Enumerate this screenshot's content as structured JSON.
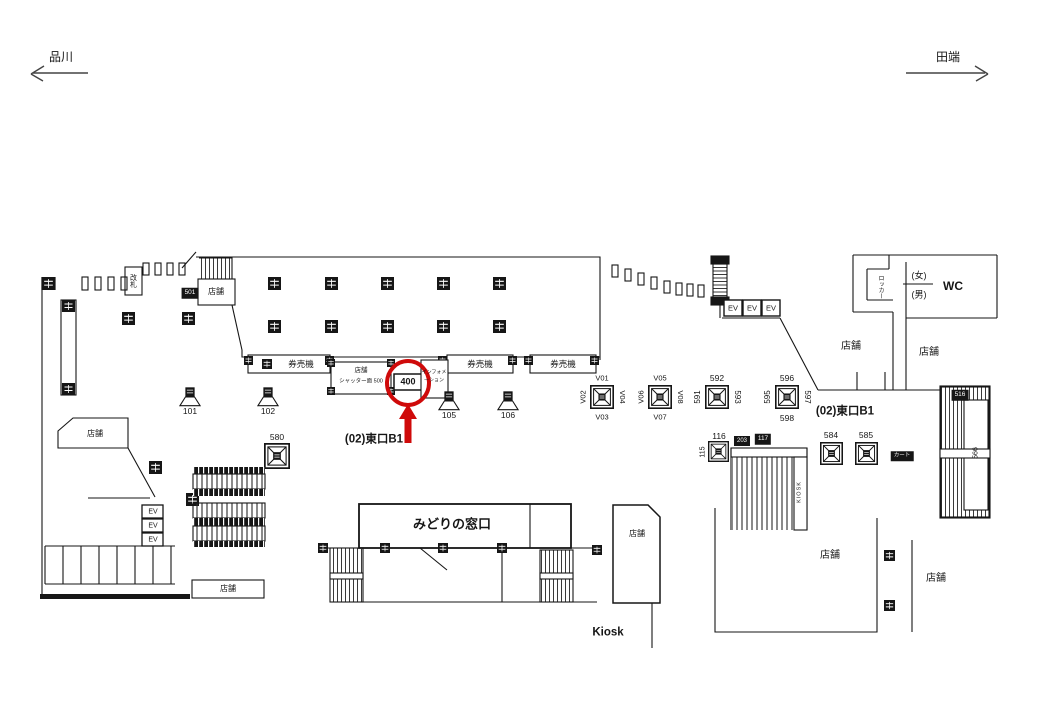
{
  "header": {
    "left_station": "品川",
    "right_station": "田端"
  },
  "areas": {
    "kaisatsu": "改札",
    "tenpo": "店舗",
    "kenbaiki": "券売機",
    "shutter_line1": "店舗",
    "shutter_line2": "シャッター面 500",
    "info_line1": "インフォメ",
    "info_line2": "ーション",
    "higashiguchi": "(02)東口B1",
    "midori": "みどりの窓口",
    "kiosk": "Kiosk",
    "kiosk_vertical": "KIOSK",
    "wc": "WC",
    "women": "(女)",
    "men": "(男)",
    "locker": "ロッカー",
    "cart": "カート",
    "ev": "EV"
  },
  "highlight": {
    "value": "400",
    "color": "#cf0a0a"
  },
  "pillars": {
    "n101": "101",
    "n102": "102",
    "n105": "105",
    "n106": "106",
    "n115": "115",
    "n116": "116",
    "n117": "117",
    "n203": "203",
    "n501": "501",
    "n516": "516",
    "n566": "566",
    "n580": "580",
    "n584": "584",
    "n585": "585",
    "n591": "591",
    "n592": "592",
    "n593": "593",
    "n595": "595",
    "n596": "596",
    "n597": "597",
    "n598": "598",
    "v01": "V01",
    "v02": "V02",
    "v03": "V03",
    "v04": "V04",
    "v05": "V05",
    "v06": "V06",
    "v07": "V07",
    "v08": "V08"
  }
}
